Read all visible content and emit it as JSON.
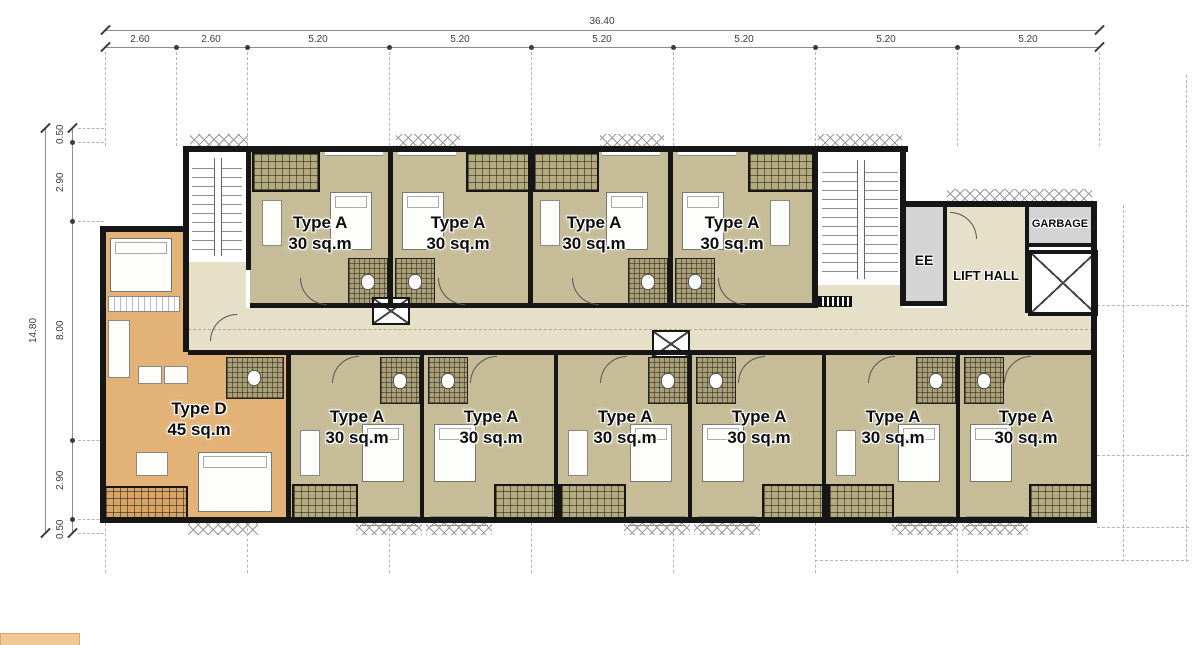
{
  "dimensions": {
    "top": {
      "total": "36.40",
      "segments": [
        "2.60",
        "2.60",
        "5.20",
        "5.20",
        "5.20",
        "5.20",
        "5.20",
        "5.20"
      ]
    },
    "left": {
      "total": "14.80",
      "segments": [
        "0.50",
        "2.90",
        "8.00",
        "2.90",
        "0.50"
      ]
    }
  },
  "units": {
    "top_row": [
      {
        "type": "Type A",
        "area": "30 sq.m"
      },
      {
        "type": "Type A",
        "area": "30 sq.m"
      },
      {
        "type": "Type A",
        "area": "30 sq.m"
      },
      {
        "type": "Type A",
        "area": "30 sq.m"
      }
    ],
    "bottom_row": [
      {
        "type": "Type D",
        "area": "45 sq.m"
      },
      {
        "type": "Type A",
        "area": "30 sq.m"
      },
      {
        "type": "Type A",
        "area": "30 sq.m"
      },
      {
        "type": "Type A",
        "area": "30 sq.m"
      },
      {
        "type": "Type A",
        "area": "30 sq.m"
      },
      {
        "type": "Type A",
        "area": "30 sq.m"
      },
      {
        "type": "Type A",
        "area": "30 sq.m"
      }
    ]
  },
  "rooms": {
    "ee": "EE",
    "lift_hall": "LIFT  HALL",
    "garbage": "GARBAGE"
  },
  "colors": {
    "unit_floor": "#c6bd98",
    "corridor": "#e7e0c9",
    "type_d_floor": "#e3b277",
    "balcony_hatch": "#b3aa80",
    "type_d_balcony": "#d9a566",
    "service_gray": "#d4d4d4",
    "wall": "#161616"
  }
}
